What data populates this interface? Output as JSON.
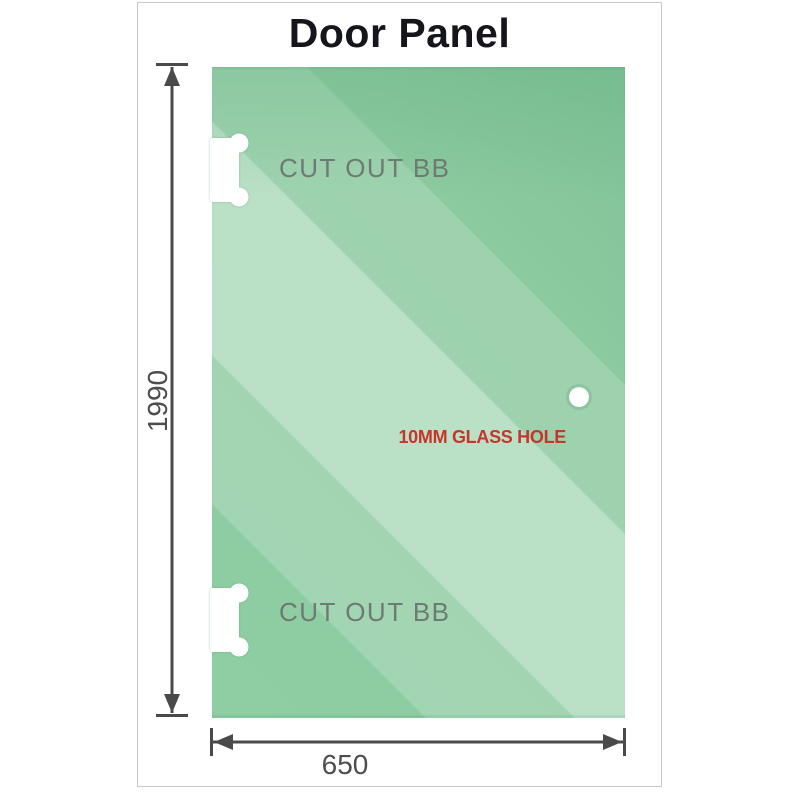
{
  "title": "Door Panel",
  "diagram": {
    "cutouts": [
      {
        "label": "CUT OUT BB"
      },
      {
        "label": "CUT OUT BB"
      }
    ],
    "glass_hole": {
      "label": "10MM GLASS HOLE"
    },
    "dimensions": {
      "height_mm": "1990",
      "width_mm": "650"
    }
  },
  "colors": {
    "glass_green": "#8fcda3",
    "glass_highlight": "#c6e8ce",
    "hole_label_red": "#c5362c",
    "dimension_gray": "#4d4d4d",
    "cutout_label_gray": "#6e7a73",
    "title_black": "#15151c",
    "frame_border": "#c9c9c9"
  }
}
